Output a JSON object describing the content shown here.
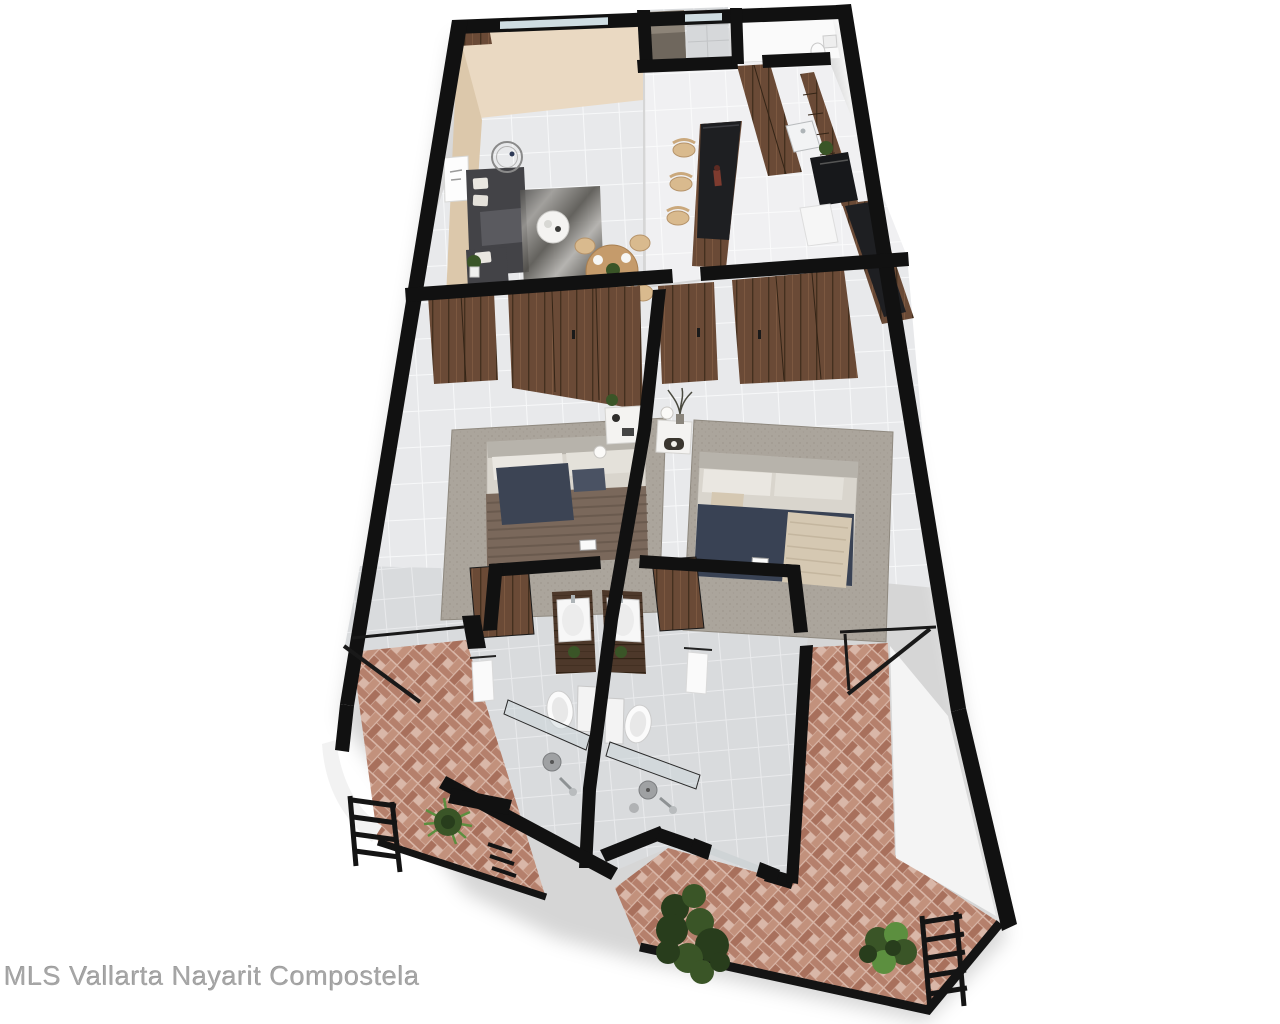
{
  "watermark": {
    "text": "MLS Vallarta Nayarit Compostela"
  },
  "scene": {
    "type": "3d-floor-plan-render",
    "description": "Top-down 3D architectural rendering of a two-bedroom, two-bathroom apartment with kitchen, living-dining room, double vanities and terracotta herringbone balconies",
    "rooms": [
      "living-room",
      "dining-area",
      "kitchen",
      "utility-closet",
      "half-bath",
      "bedroom-left",
      "bedroom-right",
      "closet-left",
      "closet-right",
      "vanity-left",
      "vanity-right",
      "bathroom-left",
      "bathroom-right",
      "balcony-left",
      "balcony-right",
      "terrace"
    ]
  },
  "palette": {
    "wall": "#111111",
    "beige": "#ead9c2",
    "beigeShade": "#dcc8ab",
    "whiteRoom": "#fafafa",
    "tileBase": "#e8e9eb",
    "tileLine": "#f7f8f9",
    "bathBase": "#d9dbdd",
    "bathLine": "#e9eaec",
    "wood": "#6a4a36",
    "woodSeam": "#44301f",
    "woodStreak": "#8a6448",
    "woodDark": "#4d382a",
    "woodDarkSeam": "#332416",
    "counter": "#1e1f22",
    "stool": "#d9ba8e",
    "sofa": "#434347",
    "sofaLight": "#5a5a5f",
    "pillowWhite": "#eae7e1",
    "linen": "#d9d5cd",
    "headboard": "#b7b3ab",
    "duvetBrown": "#7a685b",
    "duvetStripe": "#5f5146",
    "navy": "#3c4454",
    "navyDuvet": "#394254",
    "throwBeige": "#d5c8b2",
    "rug": "#aba59c",
    "rugDot": "#968f85",
    "terr1": "#b5806c",
    "terr2": "#c2917c",
    "terr3": "#a8705c",
    "terrG": "#d9b7a8",
    "green": "#3a5527",
    "greenDark": "#283d1c",
    "greenBright": "#5c8f3f",
    "glass": "#cfdde2",
    "showerGlass": "#c9d4d9",
    "chrome": "#aeb4b7",
    "watermark": "#a6a6a6"
  }
}
